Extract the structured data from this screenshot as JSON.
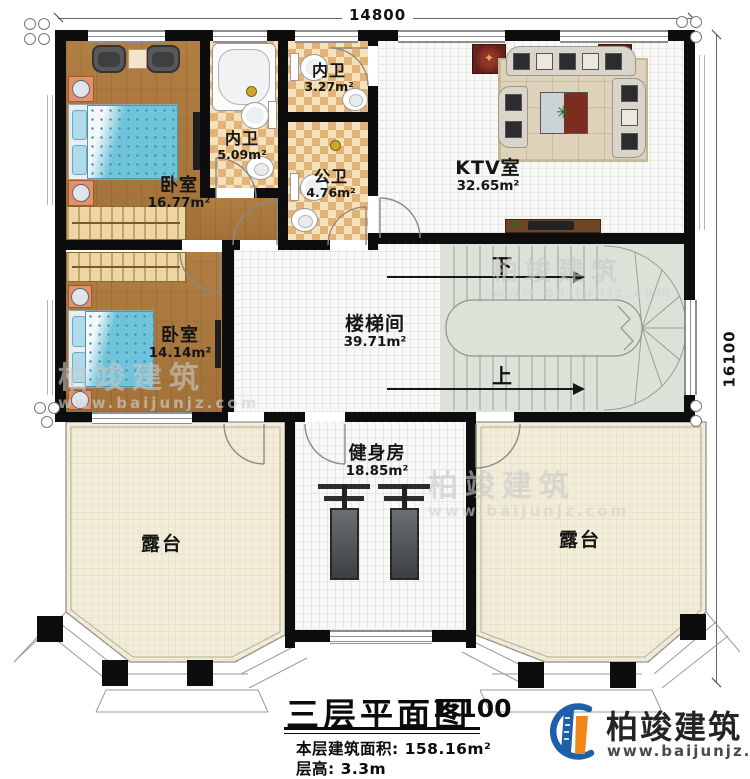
{
  "dimensions": {
    "top": "14800",
    "right": "16100"
  },
  "rooms": [
    {
      "name": "卧室",
      "area": "16.77m²"
    },
    {
      "name": "内卫",
      "area": "5.09m²"
    },
    {
      "name": "内卫",
      "area": "3.27m²"
    },
    {
      "name": "公卫",
      "area": "4.76m²"
    },
    {
      "name": "KTV室",
      "area": "32.65m²"
    },
    {
      "name": "楼梯间",
      "area": "39.71m²"
    },
    {
      "name": "卧室",
      "area": "14.14m²"
    },
    {
      "name": "健身房",
      "area": "18.85m²"
    },
    {
      "name": "露台"
    },
    {
      "name": "露台"
    }
  ],
  "stairs": {
    "down_label": "下",
    "up_label": "上"
  },
  "title_block": {
    "title": "三层平面图",
    "scale": "1:100",
    "area_text": "本层建筑面积: 158.16m²",
    "floor_height_text": "层高: 3.3m"
  },
  "brand": {
    "name": "柏竣建筑",
    "website": "www.baijunjz.com"
  },
  "colors": {
    "wall": "#0d0d0d",
    "wood_floor": "#a9793d",
    "bath_tile": "#e8c084",
    "terrace": "#f1edd8",
    "stairs": "#dce2d8",
    "bed": "#6fc3da",
    "brand_blue": "#1d5fa8",
    "brand_orange": "#f08519",
    "speaker_red": "#64201a"
  }
}
